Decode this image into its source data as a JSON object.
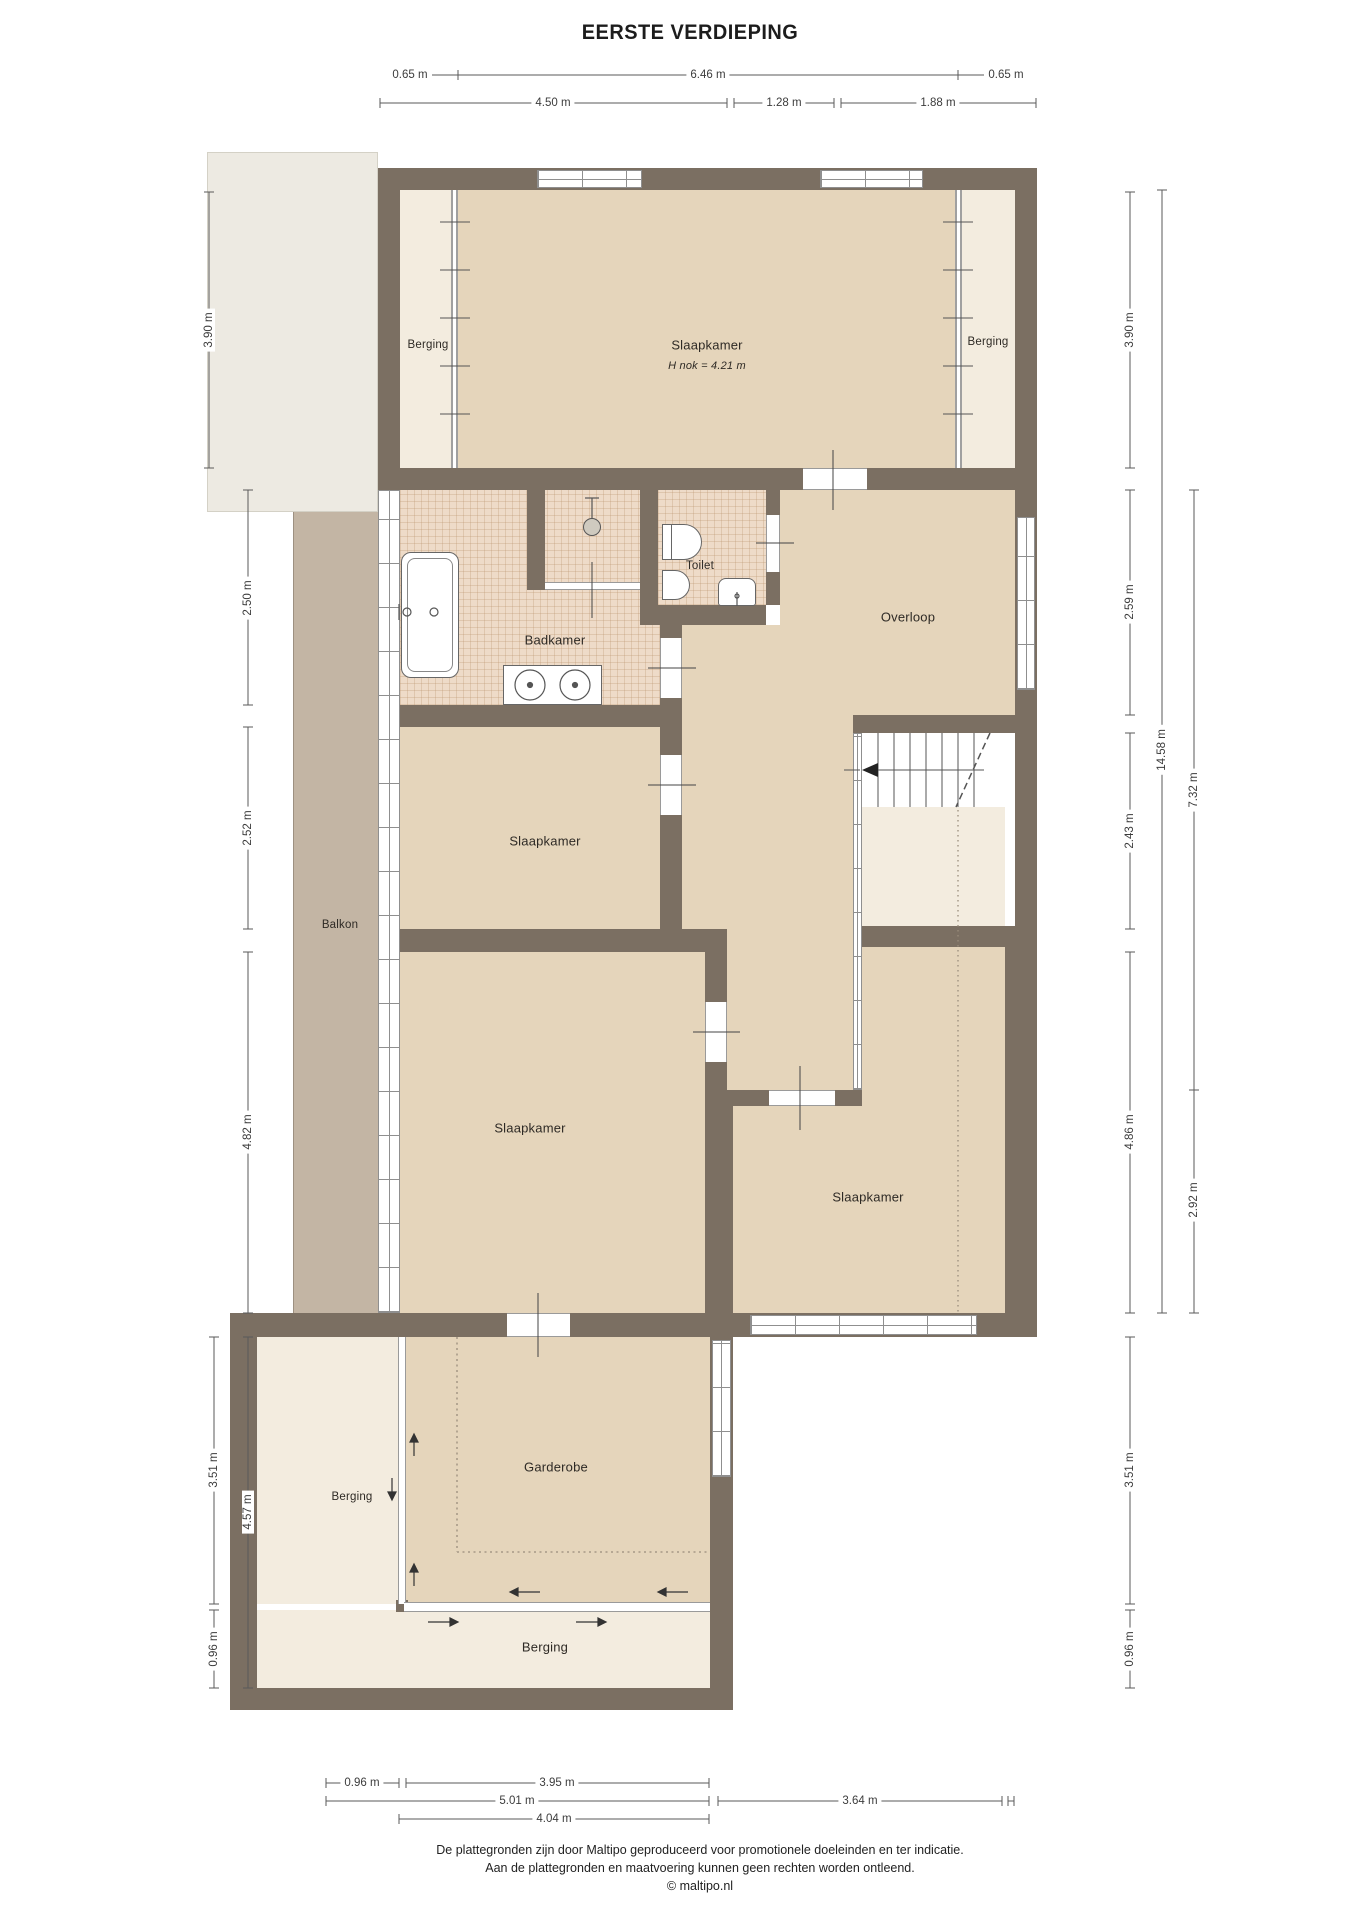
{
  "title": "EERSTE VERDIEPING",
  "rooms": {
    "slaapkamer_top": {
      "label": "Slaapkamer",
      "note": "H nok = 4.21 m"
    },
    "berging_top_left": {
      "label": "Berging"
    },
    "berging_top_right": {
      "label": "Berging"
    },
    "badkamer": {
      "label": "Badkamer"
    },
    "toilet": {
      "label": "Toilet"
    },
    "overloop": {
      "label": "Overloop"
    },
    "slaapkamer_middle": {
      "label": "Slaapkamer"
    },
    "balkon": {
      "label": "Balkon"
    },
    "slaapkamer_left": {
      "label": "Slaapkamer"
    },
    "slaapkamer_right": {
      "label": "Slaapkamer"
    },
    "garderobe": {
      "label": "Garderobe"
    },
    "berging_bottom_left": {
      "label": "Berging"
    },
    "berging_bottom": {
      "label": "Berging"
    }
  },
  "dimensions": {
    "top_row1": [
      "0.65 m",
      "6.46 m",
      "0.65 m"
    ],
    "top_row2": [
      "4.50 m",
      "1.28 m",
      "1.88 m"
    ],
    "left": [
      "3.90 m",
      "2.50 m",
      "2.52 m",
      "4.82 m",
      "3.51 m",
      "4.57 m",
      "0.96 m"
    ],
    "right": [
      "3.90 m",
      "2.59 m",
      "2.43 m",
      "4.86 m",
      "3.51 m",
      "0.96 m",
      "14.58 m",
      "7.32 m",
      "2.92 m"
    ],
    "bottom_row1": [
      "0.96 m",
      "3.95 m"
    ],
    "bottom_row2": [
      "5.01 m",
      "3.64 m"
    ],
    "bottom_row3": [
      "4.04 m"
    ]
  },
  "footer": {
    "line1": "De plattegronden zijn door Maltipo geproduceerd voor promotionele doeleinden en ter indicatie.",
    "line2": "Aan de plattegronden en maatvoering kunnen geen rechten worden ontleend.",
    "line3": "© maltipo.nl"
  },
  "colors": {
    "wall": "#7b6f62",
    "floor_tan": "#e5d5bb",
    "floor_cream": "#f3ecdf",
    "floor_tile": "#eedbc8",
    "balkon": "#c3b5a4",
    "roof": "#edeae2"
  }
}
